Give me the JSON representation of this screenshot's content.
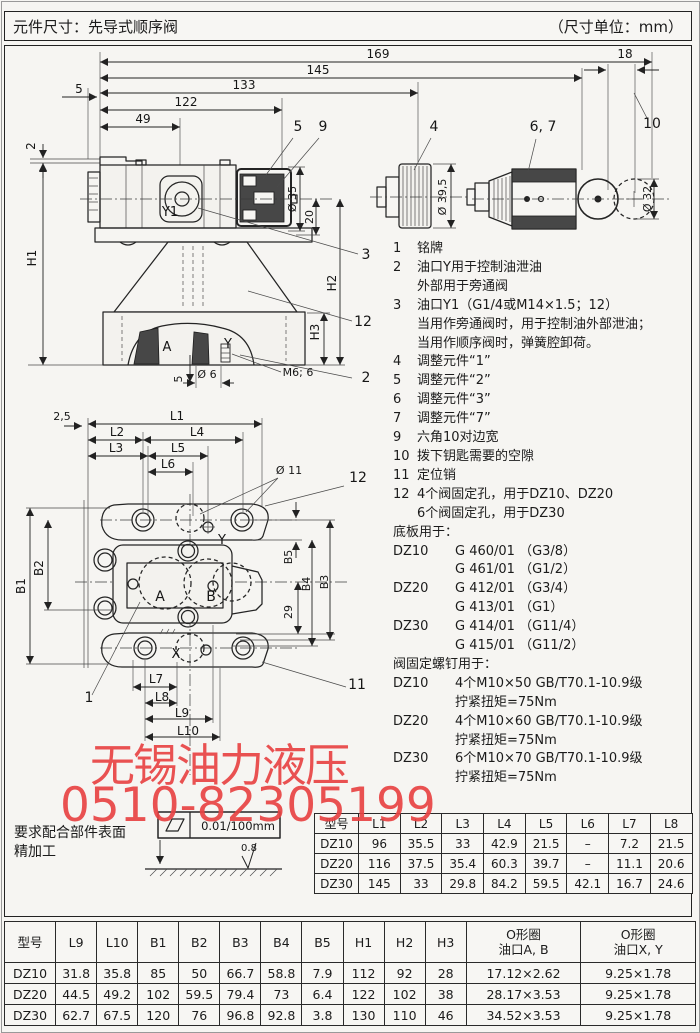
{
  "header": {
    "title": "元件尺寸：先导式顺序阀",
    "unit_note": "（尺寸单位：mm）"
  },
  "watermark": {
    "line1": "无锡油力液压",
    "line2": "0510-82305199",
    "color": "#e84444"
  },
  "surface_note": {
    "line1": "要求配合部件表面",
    "line2": "精加工",
    "flatness": "0.01/100mm",
    "roughness": "0.8"
  },
  "notes": [
    {
      "c": "n",
      "l": "1",
      "t": "铭牌"
    },
    {
      "c": "n",
      "l": "2",
      "t": "油口Y用于控制油泄油"
    },
    {
      "c": "c",
      "l": "",
      "t": "外部用于旁通阀"
    },
    {
      "c": "n",
      "l": "3",
      "t": "油口Y1（G1/4或M14×1.5；12）"
    },
    {
      "c": "c",
      "l": "",
      "t": "当用作旁通阀时，用于控制油外部泄油；"
    },
    {
      "c": "c",
      "l": "",
      "t": "当用作顺序阀时，弹簧腔卸荷。"
    },
    {
      "c": "n",
      "l": "4",
      "t": "调整元件“1”"
    },
    {
      "c": "n",
      "l": "5",
      "t": "调整元件“2”"
    },
    {
      "c": "n",
      "l": "6",
      "t": "调整元件“3”"
    },
    {
      "c": "n",
      "l": "7",
      "t": "调整元件“7”"
    },
    {
      "c": "n",
      "l": "9",
      "t": "六角10对边宽"
    },
    {
      "c": "n",
      "l": "10",
      "t": "拨下钥匙需要的空隙"
    },
    {
      "c": "n",
      "l": "11",
      "t": "定位销"
    },
    {
      "c": "n",
      "l": "12",
      "t": "4个阀固定孔，用于DZ10、DZ20"
    },
    {
      "c": "c",
      "l": "",
      "t": "6个阀固定孔，用于DZ30"
    },
    {
      "c": "h",
      "l": "",
      "t": "底板用于："
    },
    {
      "c": "m",
      "l": "DZ10",
      "t": "G 460/01 （G3/8）"
    },
    {
      "c": "mc",
      "l": "",
      "t": "G 461/01 （G1/2）"
    },
    {
      "c": "m",
      "l": "DZ20",
      "t": "G 412/01 （G3/4）"
    },
    {
      "c": "mc",
      "l": "",
      "t": "G 413/01 （G1）"
    },
    {
      "c": "m",
      "l": "DZ30",
      "t": "G 414/01 （G11/4）"
    },
    {
      "c": "mc",
      "l": "",
      "t": "G 415/01 （G11/2）"
    },
    {
      "c": "h",
      "l": "",
      "t": "阀固定螺钉用于："
    },
    {
      "c": "m",
      "l": "DZ10",
      "t": "4个M10×50  GB/T70.1-10.9级"
    },
    {
      "c": "mc",
      "l": "",
      "t": "拧紧扭矩=75Nm"
    },
    {
      "c": "m",
      "l": "DZ20",
      "t": "4个M10×60  GB/T70.1-10.9级"
    },
    {
      "c": "mc",
      "l": "",
      "t": "拧紧扭矩=75Nm"
    },
    {
      "c": "m",
      "l": "DZ30",
      "t": "6个M10×70  GB/T70.1-10.9级"
    },
    {
      "c": "mc",
      "l": "",
      "t": "拧紧扭矩=75Nm"
    }
  ],
  "table1": {
    "headers": [
      "型号",
      "L1",
      "L2",
      "L3",
      "L4",
      "L5",
      "L6",
      "L7",
      "L8"
    ],
    "rows": [
      [
        "DZ10",
        "96",
        "35.5",
        "33",
        "42.9",
        "21.5",
        "–",
        "7.2",
        "21.5"
      ],
      [
        "DZ20",
        "116",
        "37.5",
        "35.4",
        "60.3",
        "39.7",
        "–",
        "11.1",
        "20.6"
      ],
      [
        "DZ30",
        "145",
        "33",
        "29.8",
        "84.2",
        "59.5",
        "42.1",
        "16.7",
        "24.6"
      ]
    ]
  },
  "table2": {
    "headers": [
      "型号",
      "L9",
      "L10",
      "B1",
      "B2",
      "B3",
      "B4",
      "B5",
      "H1",
      "H2",
      "H3",
      "O形圈|油口A, B",
      "O形圈|油口X, Y"
    ],
    "rows": [
      [
        "DZ10",
        "31.8",
        "35.8",
        "85",
        "50",
        "66.7",
        "58.8",
        "7.9",
        "112",
        "92",
        "28",
        "17.12×2.62",
        "9.25×1.78"
      ],
      [
        "DZ20",
        "44.5",
        "49.2",
        "102",
        "59.5",
        "79.4",
        "73",
        "6.4",
        "122",
        "102",
        "38",
        "28.17×3.53",
        "9.25×1.78"
      ],
      [
        "DZ30",
        "62.7",
        "67.5",
        "120",
        "76",
        "96.8",
        "92.8",
        "3.8",
        "130",
        "110",
        "46",
        "34.52×3.53",
        "9.25×1.78"
      ]
    ]
  },
  "svg_labels": [
    {
      "t": "169",
      "x": 378,
      "y": 58
    },
    {
      "t": "18",
      "x": 625,
      "y": 58
    },
    {
      "t": "145",
      "x": 318,
      "y": 74
    },
    {
      "t": "133",
      "x": 244,
      "y": 89
    },
    {
      "t": "122",
      "x": 186,
      "y": 106
    },
    {
      "t": "49",
      "x": 143,
      "y": 123
    },
    {
      "t": "5",
      "x": 79,
      "y": 93
    },
    {
      "t": "2",
      "x": 35,
      "y": 146,
      "r": -90
    },
    {
      "t": "H1",
      "x": 36,
      "y": 258,
      "r": -90
    },
    {
      "t": "5",
      "x": 298,
      "y": 131,
      "fs": 14
    },
    {
      "t": "9",
      "x": 323,
      "y": 131,
      "fs": 14
    },
    {
      "t": "4",
      "x": 434,
      "y": 131,
      "fs": 14
    },
    {
      "t": "6, 7",
      "x": 543,
      "y": 131,
      "fs": 14
    },
    {
      "t": "10",
      "x": 652,
      "y": 128,
      "fs": 14
    },
    {
      "t": "Y1",
      "x": 170,
      "y": 216,
      "fs": 13
    },
    {
      "t": "Ø 35",
      "x": 296,
      "y": 199,
      "r": -90,
      "fs": 11
    },
    {
      "t": "20",
      "x": 313,
      "y": 217,
      "r": -90,
      "fs": 11
    },
    {
      "t": "H2",
      "x": 336,
      "y": 283,
      "r": -90
    },
    {
      "t": "H3",
      "x": 319,
      "y": 332,
      "r": -90
    },
    {
      "t": "Ø 39,5",
      "x": 446,
      "y": 197,
      "r": -90,
      "fs": 11
    },
    {
      "t": "Ø 32",
      "x": 651,
      "y": 199,
      "r": -90,
      "fs": 11
    },
    {
      "t": "3",
      "x": 366,
      "y": 259,
      "fs": 14
    },
    {
      "t": "12",
      "x": 363,
      "y": 326,
      "fs": 14
    },
    {
      "t": "A",
      "x": 167,
      "y": 351,
      "fs": 13
    },
    {
      "t": "Y",
      "x": 228,
      "y": 348,
      "fs": 13
    },
    {
      "t": "M6; 6",
      "x": 298,
      "y": 376,
      "fs": 11
    },
    {
      "t": "2",
      "x": 366,
      "y": 382,
      "fs": 14
    },
    {
      "t": "Ø 6",
      "x": 207,
      "y": 378,
      "fs": 11
    },
    {
      "t": "5",
      "x": 182,
      "y": 379,
      "r": -90,
      "fs": 11
    },
    {
      "t": "2,5",
      "x": 62,
      "y": 420,
      "fs": 11
    },
    {
      "t": "L1",
      "x": 177,
      "y": 420
    },
    {
      "t": "L2",
      "x": 117,
      "y": 436
    },
    {
      "t": "L4",
      "x": 197,
      "y": 436
    },
    {
      "t": "L3",
      "x": 116,
      "y": 452
    },
    {
      "t": "L5",
      "x": 178,
      "y": 452
    },
    {
      "t": "L6",
      "x": 168,
      "y": 468
    },
    {
      "t": "Ø 11",
      "x": 289,
      "y": 474,
      "fs": 11
    },
    {
      "t": "12",
      "x": 358,
      "y": 482,
      "fs": 14
    },
    {
      "t": "B1",
      "x": 25,
      "y": 586,
      "r": -90
    },
    {
      "t": "B2",
      "x": 43,
      "y": 568,
      "r": -90
    },
    {
      "t": "Y",
      "x": 222,
      "y": 544,
      "fs": 13
    },
    {
      "t": "B5",
      "x": 292,
      "y": 557,
      "r": -90,
      "fs": 11
    },
    {
      "t": "B4",
      "x": 310,
      "y": 584,
      "r": -90,
      "fs": 11
    },
    {
      "t": "B3",
      "x": 328,
      "y": 582,
      "r": -90,
      "fs": 11
    },
    {
      "t": "29",
      "x": 292,
      "y": 612,
      "r": -90,
      "fs": 11
    },
    {
      "t": "A",
      "x": 160,
      "y": 601,
      "fs": 14
    },
    {
      "t": "B",
      "x": 211,
      "y": 601,
      "fs": 14
    },
    {
      "t": "X",
      "x": 176,
      "y": 658,
      "fs": 13
    },
    {
      "t": "L7",
      "x": 156,
      "y": 683
    },
    {
      "t": "L8",
      "x": 162,
      "y": 701
    },
    {
      "t": "L9",
      "x": 182,
      "y": 717
    },
    {
      "t": "L10",
      "x": 188,
      "y": 735
    },
    {
      "t": "1",
      "x": 89,
      "y": 702,
      "fs": 14
    },
    {
      "t": "11",
      "x": 357,
      "y": 689,
      "fs": 14
    },
    {
      "t": "0.8",
      "x": 249,
      "y": 851,
      "fs": 10
    },
    {
      "t": "0.01/100mm",
      "x": 238,
      "y": 830,
      "fs": 11.5
    }
  ]
}
